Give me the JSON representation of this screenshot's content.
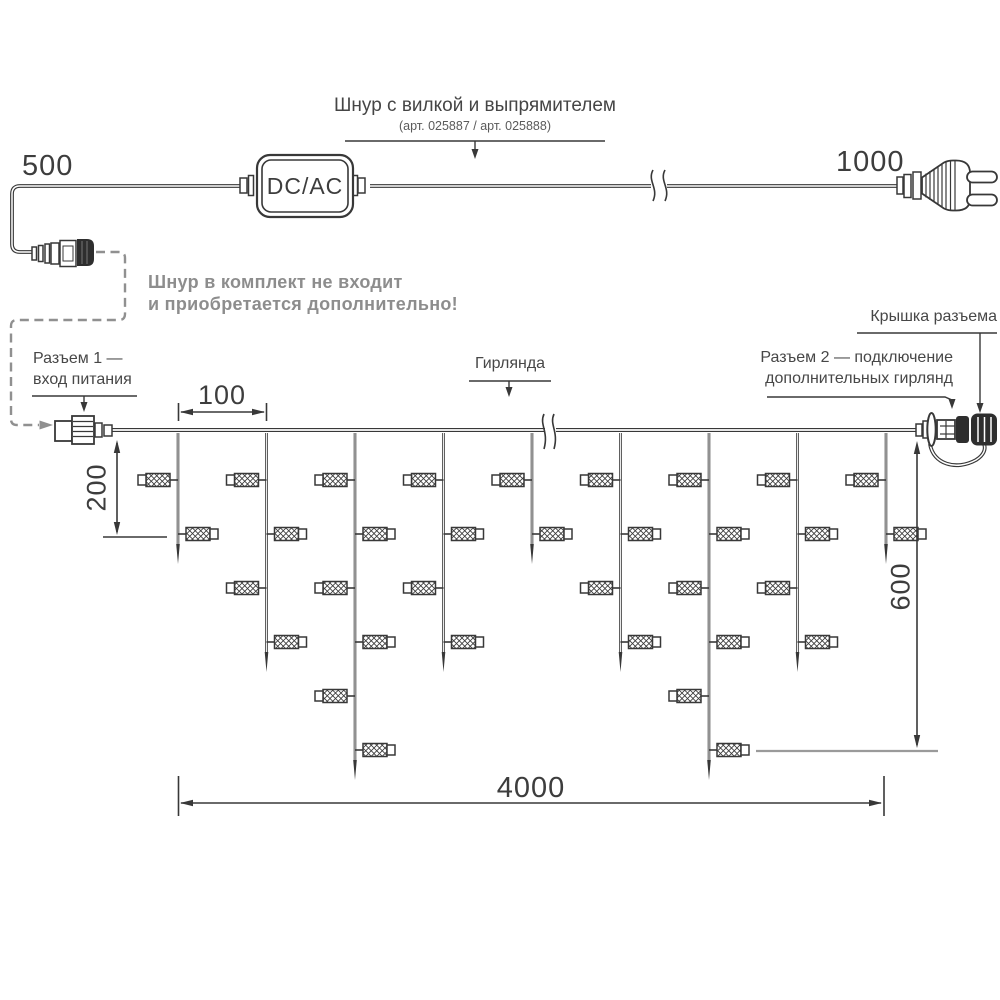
{
  "diagram": {
    "power_cord": {
      "title": "Шнур с вилкой и выпрямителем",
      "part_numbers": "(арт. 025887 / арт. 025888)",
      "converter_label": "DC/AC",
      "note_line1": "Шнур в комплект не входит",
      "note_line2": "и приобретается дополнительно!",
      "dim_left": "500",
      "dim_right": "1000"
    },
    "garland": {
      "label": "Гирлянда",
      "connector1_line1": "Разъем 1 —",
      "connector1_line2": "вход питания",
      "connector2_line1": "Разъем 2 — подключение",
      "connector2_line2": "дополнительных гирлянд",
      "cap_label": "Крышка разъема",
      "dim_drop_spacing": "100",
      "dim_first_drop": "200",
      "dim_height": "600",
      "dim_length": "4000",
      "structure": {
        "wire_y": 430,
        "wire_x_start": 112,
        "wire_x_end": 916,
        "break_x": 549,
        "drop_xs": [
          178,
          266.5,
          355,
          443.5,
          532,
          620.5,
          709,
          797.5,
          886
        ],
        "lamp_counts": [
          2,
          4,
          6,
          4,
          2,
          4,
          6,
          4,
          2
        ],
        "row_ys": [
          480,
          534,
          588,
          642,
          696,
          750
        ],
        "tip_extra": 30,
        "lamp": {
          "body_w": 24,
          "body_h": 13,
          "cap_w": 8,
          "cap_h": 10,
          "stub": 8
        }
      }
    },
    "colors": {
      "line": "#383838",
      "gray": "#909090",
      "black_fill": "#2e2e2e"
    }
  }
}
